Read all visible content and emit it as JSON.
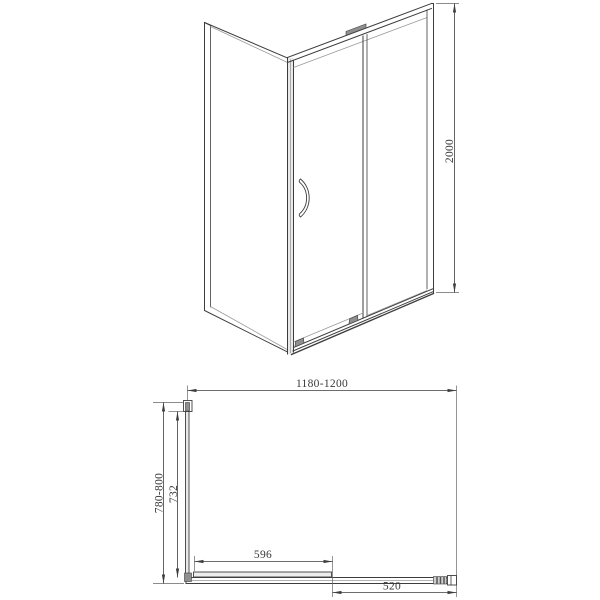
{
  "colors": {
    "background": "#ffffff",
    "line": "#3d3d3d",
    "lightLine": "#9a9a9a",
    "extLine": "#666666",
    "fillLight": "#e9e9e9",
    "fillMid": "#8f8f8f",
    "text": "#3a3a3a"
  },
  "dimensions": {
    "height": "2000",
    "width_range": "1180-1200",
    "depth_range": "780-800",
    "glass_depth": "732",
    "door_panel_width": "596",
    "opening_width": "520"
  }
}
